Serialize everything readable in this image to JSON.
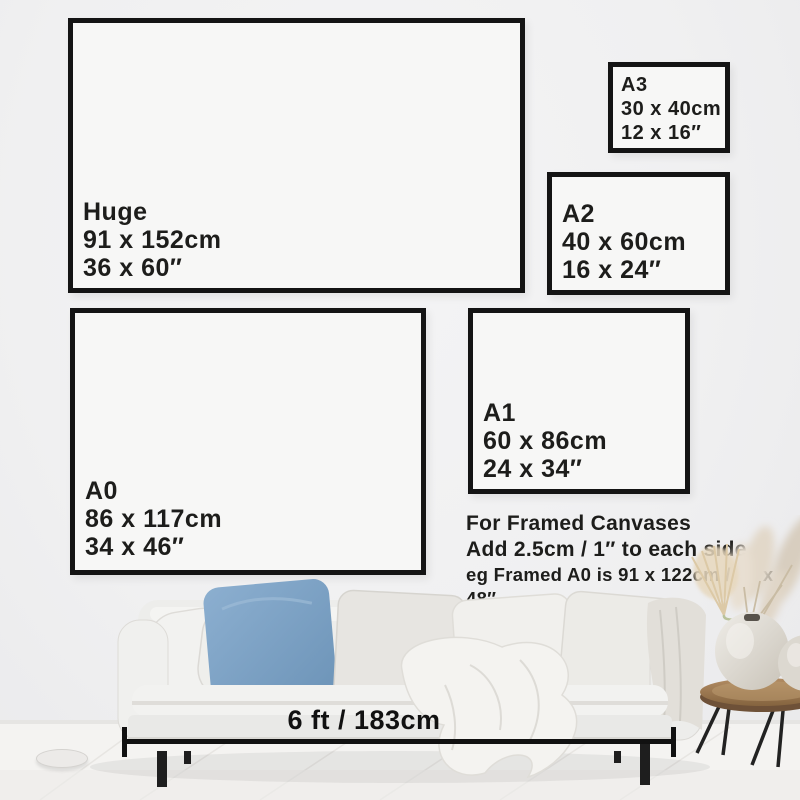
{
  "frames": [
    {
      "name": "Huge",
      "cm": "91 x 152cm",
      "inches": "36 x 60″"
    },
    {
      "name": "A3",
      "cm": "30 x 40cm",
      "inches": "12 x 16″"
    },
    {
      "name": "A2",
      "cm": "40 x 60cm",
      "inches": "16 x 24″"
    },
    {
      "name": "A0",
      "cm": "86 x 117cm",
      "inches": "34 x 46″"
    },
    {
      "name": "A1",
      "cm": "60 x 86cm",
      "inches": "24 x 34″"
    }
  ],
  "framed_note": {
    "title": "For Framed Canvases",
    "line1": "Add 2.5cm / 1″ to each side",
    "line2": "eg Framed A0 is 91 x 122cm / 36 x 48″"
  },
  "measurement": {
    "label": "6 ft / 183cm"
  },
  "colors": {
    "wall": "#f0f0f1",
    "frame-border": "#141414",
    "frame-fill": "#f7f7f6",
    "text": "#1d1d1b",
    "measure": "#111111",
    "pillow-blue": "#7ba3c6",
    "sofa": "#eeeeec",
    "wood": "#9a7650"
  }
}
